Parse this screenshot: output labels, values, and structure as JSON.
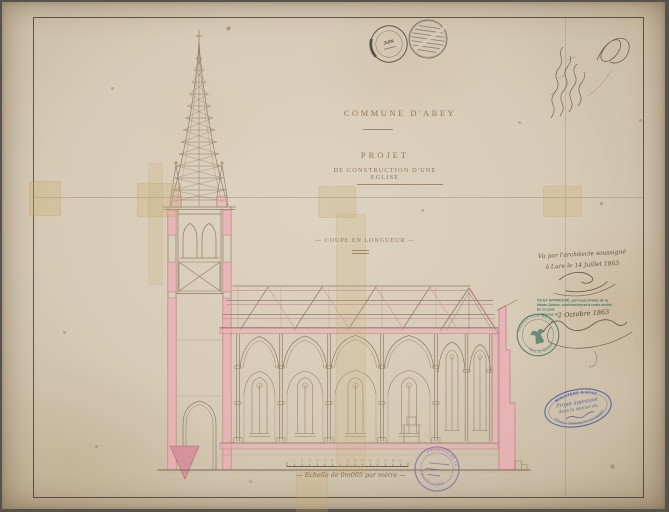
{
  "colors": {
    "paper": "#d8cdba",
    "pink_wash": "#ecacb5",
    "pink_line": "#c4707e",
    "ink_brown": "#8b7560",
    "stamp_green": "#2e6b57",
    "stamp_blue": "#3e51a0",
    "stamp_purple": "#7561ab",
    "postmark_black": "#2b2b2b"
  },
  "titles": {
    "commune": "COMMUNE D'ABEY",
    "project": "PROJET",
    "subtitle": "DE CONSTRUCTION D'UNE EGLISE",
    "section_label": "— COUPE EN LONGUEUR —",
    "scale_caption": "— Echelle de 0m005 par mètre —"
  },
  "scale_numbers": [
    "1",
    "2",
    "3",
    "4",
    "5",
    "6",
    "7",
    "8",
    "9",
    "10",
    "11",
    "12",
    "13",
    "14",
    "15"
  ],
  "architect_note": {
    "line1": "Vu par l'architecte soussigné",
    "line2": "à Lure le 14 Juillet 1863"
  },
  "prefecture_stamp": {
    "line1": "VU ET APPROUVÉ, par nous Préfet de la",
    "line2": "Haute-Saône, conformément à notre arrêté",
    "line3": "de ce jour.",
    "line4": "Vesoul, le",
    "date": "2 Octobre 1863"
  },
  "prefecture_seal": {
    "rim_top": "PRÉFECTURE DE LA",
    "rim_bottom": "HAUTE-SAÔNE"
  },
  "ministry_stamp": {
    "rim_top": "MINISTÈRE D'ÉTAT",
    "rim_bottom": "CONSEIL GÉNÉRAL DES BÂTIMENTS",
    "center1": "Projet approuvé",
    "center2": "dans la séance du"
  },
  "archives_stamp": {
    "rim_top": "ARCHIVES DE LA",
    "rim_bottom": "HAUTE-SAÔNE"
  },
  "postmark": {
    "month": "JUIN"
  }
}
